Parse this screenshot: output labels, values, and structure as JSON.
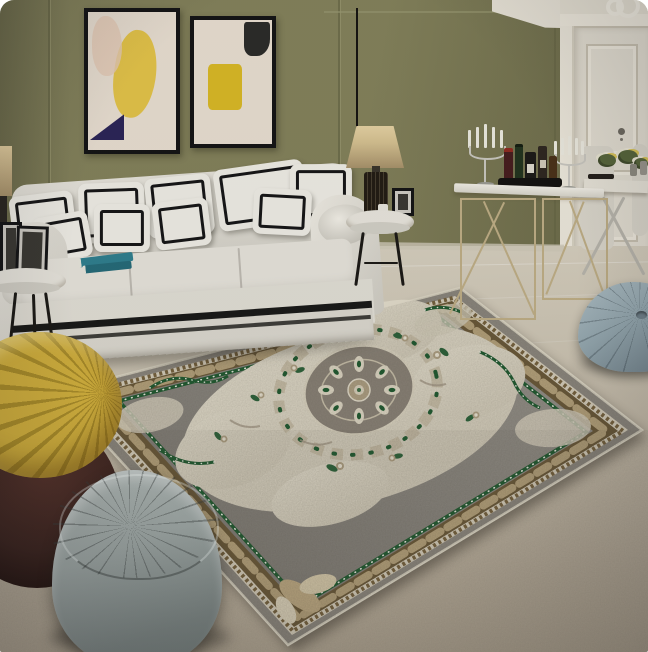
{
  "scene": {
    "type": "product-photo",
    "description": "Living room scene showcasing a large classic European medallion area rug in grey, cream, brown and green, with a white tufted-pillow sofa against an olive panelled wall, abstract wall art, a gold wireframe bar console with candelabras and bottles, a dining nook, and yellow, grey and blue-grey poufs on a beige floor"
  },
  "objects": {
    "scene": "living room product photo of a medallion area rug",
    "wall": "olive green panelled wall",
    "ceiling": "white ceiling with crown moulding",
    "artwork_left": "abstract framed artwork with yellow and navy shapes",
    "artwork_right": "abstract framed artwork with yellow and black shapes",
    "door": "white panelled door",
    "floor": "beige stone tile floor",
    "sofa": "white roll-arm sofa with black-trim pillows",
    "books": "stack of teal books on sofa seat",
    "side_table_left": "round side table with picture frames",
    "side_table_right": "round side table with lamp, frame and cup",
    "lamp": "table lamp with beige shade and dark cage base",
    "console_table": "gold wireframe bar console with candelabras and liquor bottles",
    "dining_set": "white dining table with X-frame legs, chairs and flowers",
    "rug": "grey and cream medallion area rug with brown acanthus border and green accents",
    "yellow_pouf": "yellow pleated pouf chair on dark leather base",
    "gray_pouf": "grey quilted triangular pouf",
    "teal_pouf": "blue-grey Moroccan pouf"
  },
  "palette": {
    "wall_olive": "#83815a",
    "wall_olive_dark": "#656443",
    "wall_seam": "#5f5e3f",
    "ceiling_white": "#e9e4d7",
    "door_white": "#e6e1d3",
    "door_panel_shadow": "#c9c2b1",
    "floor_tile_light": "#d9d2c1",
    "floor_fore": "#b3a895",
    "baseboard": "#cfc9b8",
    "sofa_white": "#e7e4db",
    "sofa_shadow": "#c6c3b9",
    "pillow_white": "#efede5",
    "pillow_trim": "#161616",
    "skirt_white": "#dbd8ce",
    "stripe_black": "#191917",
    "rug_edge_cream": "#d8d2c0",
    "rug_band_gray": "#8f8a80",
    "rug_geo_cream": "#ddd5c1",
    "rug_geo_brown": "#77623c",
    "rug_brown": "#6b5937",
    "rug_leaf_gold": "#c2ad84",
    "rug_green": "#1d5a2e",
    "rug_dot_white": "#f1f1e8",
    "rug_field_light": "#9a968d",
    "rug_field_dark": "#7b7770",
    "rug_cream": "#e5dfcd",
    "rug_cream_dim": "#d6cfbc",
    "rug_taupe": "#b0a183",
    "rug_disc": "#8b8377",
    "pouf_yellow": "#d2b03c",
    "pouf_yellow_dark": "#a98c28",
    "pouf_leather": "#3b241e",
    "pouf_gray": "#9ba4a1",
    "pouf_gray_dark": "#79827f",
    "pouf_teal": "#94a7ae",
    "pouf_teal_dark": "#76878f",
    "metal_gold": "#bfae85",
    "metal_silver": "#c9c7bf",
    "frame_black": "#141414",
    "art_cream": "#e8ded0",
    "art_yellow": "#e3c348",
    "art_yellow2": "#d9b825",
    "art_navy": "#2b2456",
    "art_black": "#2b2b28",
    "book_teal": "#2f7f8e",
    "candle_white": "#eceadf",
    "lamp_shade": "#d5c190",
    "lamp_dark": "#221c13",
    "chrome": "#b9b6ac",
    "flower_green": "#57663a",
    "bottle_dark": "#1c1a17",
    "tray_black": "#141210",
    "shadow": "rgba(30,26,20,0.35)"
  }
}
